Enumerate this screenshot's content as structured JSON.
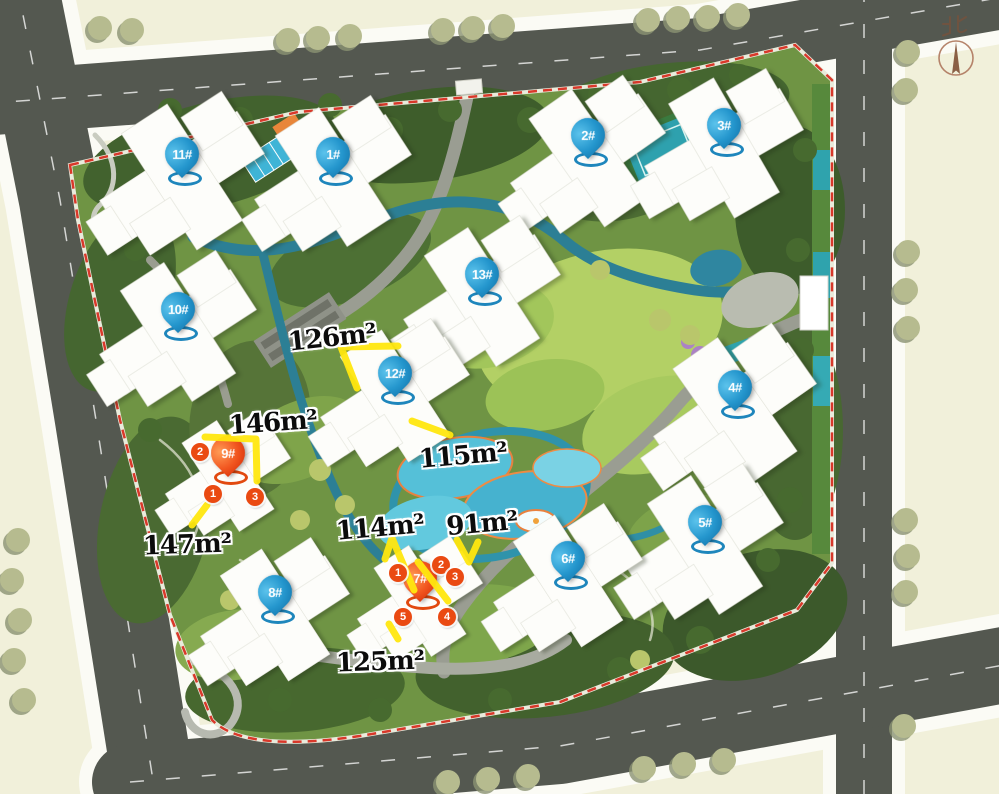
{
  "map": {
    "description": "residential community site plan",
    "north_label": "北"
  },
  "legend_colors": {
    "pin_blue": "#2496cd",
    "pin_red": "#e8431a",
    "highlight_yellow": "#ffe70f",
    "boundary_red": "#d9382a"
  },
  "buildings": [
    {
      "label": "11#",
      "color": "blue",
      "x": 182,
      "y": 157
    },
    {
      "label": "1#",
      "color": "blue",
      "x": 333,
      "y": 157
    },
    {
      "label": "2#",
      "color": "blue",
      "x": 588,
      "y": 138
    },
    {
      "label": "3#",
      "color": "blue",
      "x": 724,
      "y": 128
    },
    {
      "label": "10#",
      "color": "blue",
      "x": 178,
      "y": 312
    },
    {
      "label": "13#",
      "color": "blue",
      "x": 482,
      "y": 277
    },
    {
      "label": "12#",
      "color": "blue",
      "x": 395,
      "y": 376
    },
    {
      "label": "4#",
      "color": "blue",
      "x": 735,
      "y": 390
    },
    {
      "label": "9#",
      "color": "red",
      "x": 228,
      "y": 456
    },
    {
      "label": "5#",
      "color": "blue",
      "x": 705,
      "y": 525
    },
    {
      "label": "6#",
      "color": "blue",
      "x": 568,
      "y": 561
    },
    {
      "label": "8#",
      "color": "blue",
      "x": 275,
      "y": 595
    },
    {
      "label": "7#",
      "color": "red",
      "x": 420,
      "y": 581
    }
  ],
  "area_labels": [
    {
      "text": "126m²",
      "x": 332,
      "y": 338,
      "tilt": -6
    },
    {
      "text": "146m²",
      "x": 273,
      "y": 423,
      "tilt": -4
    },
    {
      "text": "115m²",
      "x": 463,
      "y": 456,
      "tilt": -5
    },
    {
      "text": "114m²",
      "x": 380,
      "y": 528,
      "tilt": -5
    },
    {
      "text": "91m²",
      "x": 482,
      "y": 524,
      "tilt": -5
    },
    {
      "text": "147m²",
      "x": 187,
      "y": 545,
      "tilt": -2
    },
    {
      "text": "125m²",
      "x": 380,
      "y": 662,
      "tilt": -2
    }
  ],
  "unit_markers": [
    {
      "text": "2",
      "x": 200,
      "y": 452
    },
    {
      "text": "1",
      "x": 213,
      "y": 494
    },
    {
      "text": "3",
      "x": 255,
      "y": 497
    },
    {
      "text": "1",
      "x": 398,
      "y": 573
    },
    {
      "text": "2",
      "x": 441,
      "y": 565
    },
    {
      "text": "3",
      "x": 455,
      "y": 577
    },
    {
      "text": "5",
      "x": 403,
      "y": 617
    },
    {
      "text": "4",
      "x": 447,
      "y": 617
    }
  ],
  "highlight_lines": [
    {
      "points": "398,346 341,347 357,388"
    },
    {
      "points": "205,437 256,439 257,481"
    },
    {
      "points": "192,525 207,505"
    },
    {
      "points": "412,421 450,435"
    },
    {
      "points": "385,559 392,538 414,590"
    },
    {
      "points": "418,562 448,601"
    },
    {
      "points": "457,540 469,562 478,542"
    },
    {
      "points": "389,624 398,639"
    }
  ]
}
